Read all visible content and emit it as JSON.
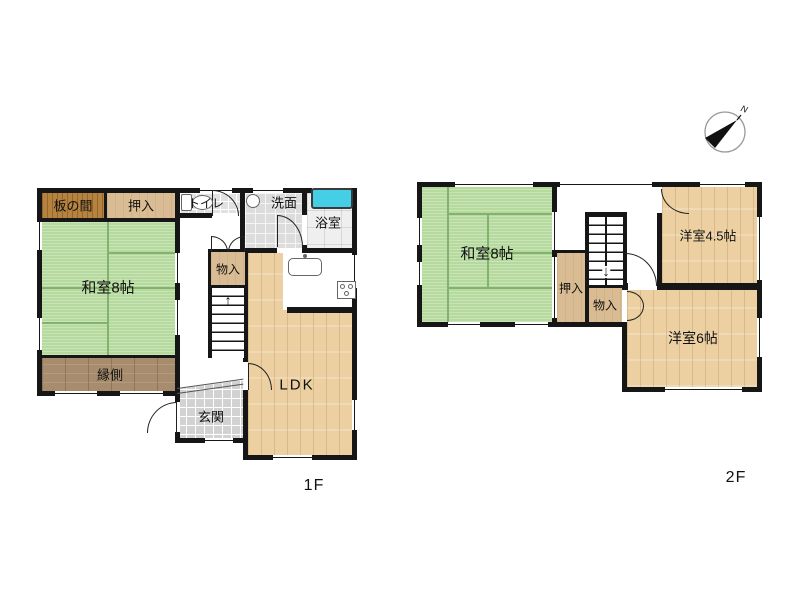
{
  "plan": {
    "floor1": {
      "label": "1F",
      "rooms": {
        "itanoma": "板の間",
        "oshiire": "押入",
        "toilet": "トイレ",
        "washroom": "洗面",
        "bathroom": "浴室",
        "washitsu": "和室8帖",
        "engawa": "縁側",
        "storage": "物入",
        "ldk": "LDK",
        "genkan": "玄関"
      }
    },
    "floor2": {
      "label": "2F",
      "rooms": {
        "washitsu": "和室8帖",
        "oshiire": "押入",
        "storage": "物入",
        "western45": "洋室4.5帖",
        "western6": "洋室6帖"
      }
    },
    "compass": {
      "north": "N"
    },
    "icons": {
      "arrow_up": "↑",
      "arrow_down": "↓"
    },
    "colors": {
      "tatami_green": "#b6da9e",
      "wood_floor": "#ecd0a2",
      "closet_tan": "#d9bc93",
      "itanoma_wood": "#b5823f",
      "engawa_brown": "#a78d6e",
      "bathtub_cyan": "#45cfe6",
      "wall_black": "#161616"
    }
  }
}
